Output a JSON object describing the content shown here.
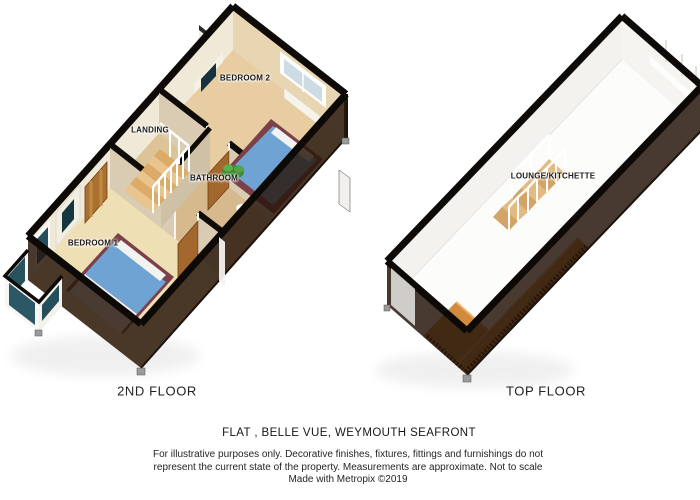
{
  "plans": [
    {
      "floor_label": "2ND FLOOR",
      "rooms": [
        {
          "label": "BEDROOM 2"
        },
        {
          "label": "LANDING"
        },
        {
          "label": "BATHROOM"
        },
        {
          "label": "BEDROOM 1"
        }
      ]
    },
    {
      "floor_label": "TOP FLOOR",
      "rooms": [
        {
          "label": "LOUNGE/KITCHETTE"
        }
      ]
    }
  ],
  "caption": {
    "title": "FLAT ,  BELLE VUE, WEYMOUTH SEAFRONT",
    "disclaimer_line1": "For illustrative purposes only.  Decorative finishes, fixtures, fittings and furnishings do not",
    "disclaimer_line2": "represent the current state of the property.  Measurements are approximate.  Not to scale",
    "credit": "Made with Metropix ©2019"
  },
  "colors": {
    "wall_dark": "#2b1a0e",
    "wall_edge_black": "#0d0a08",
    "floor_cream": "#e9d3a6",
    "bed_blue": "#6fa3d4",
    "bed_base_maroon": "#7c4048",
    "door_wood": "#a2672c",
    "counter_orange": "#d28a3e",
    "stair_wood": "#dcab67",
    "glass_teal": "#28525e"
  }
}
